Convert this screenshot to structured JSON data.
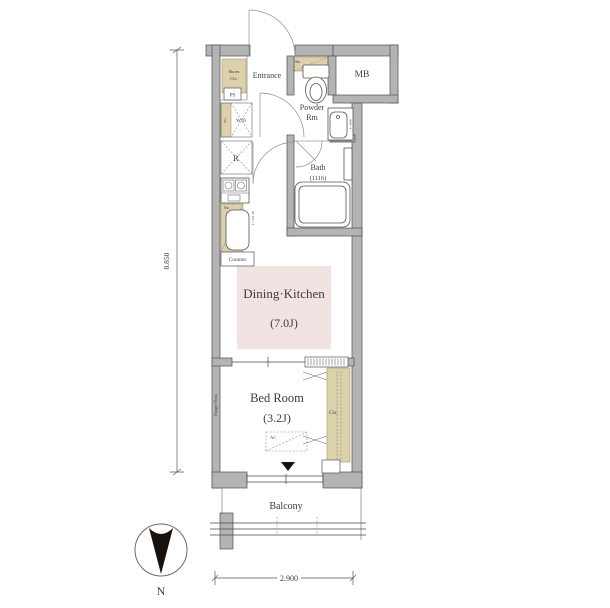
{
  "labels": {
    "entrance": "Entrance",
    "shoes_closet_line1": "Shoes",
    "shoes_closet_line2": "Clo.",
    "pipe_space": "PS",
    "meter_box": "MB",
    "storage_shelf": "Sto.",
    "powder_room_line1": "Powder",
    "powder_room_line2": "Rm",
    "washbasin_note": "L=600",
    "washer_dryer": "W/D",
    "washer_dryer_storage": "Sto.",
    "refrigerator": "R",
    "kitchen_storage": "Sto.",
    "kitchen_counter_length": "L=W1.50",
    "counter": "Counter",
    "bath": "Bath",
    "bath_size": "(1116)",
    "dining_kitchen": "Dining·Kitchen",
    "dining_kitchen_size": "(7.0J)",
    "bed_room": "Bed Room",
    "bed_room_size": "(3.2J)",
    "hanger_hook": "Hanger Hook",
    "closet": "Clo.",
    "air_conditioner": "AC",
    "balcony": "Balcony"
  },
  "dimensions": {
    "height_total": "8.850",
    "width_total": "2.900"
  },
  "compass": {
    "north_label": "N"
  },
  "colors": {
    "wall_fill": "#b4b4b4",
    "wall_outline": "#4f4f4f",
    "storage_fill": "#dbd1ab",
    "storage_outline": "#a89a6a",
    "dk_highlight_fill": "#f1e3e1",
    "line_color": "#4a4a4a",
    "marker_black": "#17120d"
  }
}
